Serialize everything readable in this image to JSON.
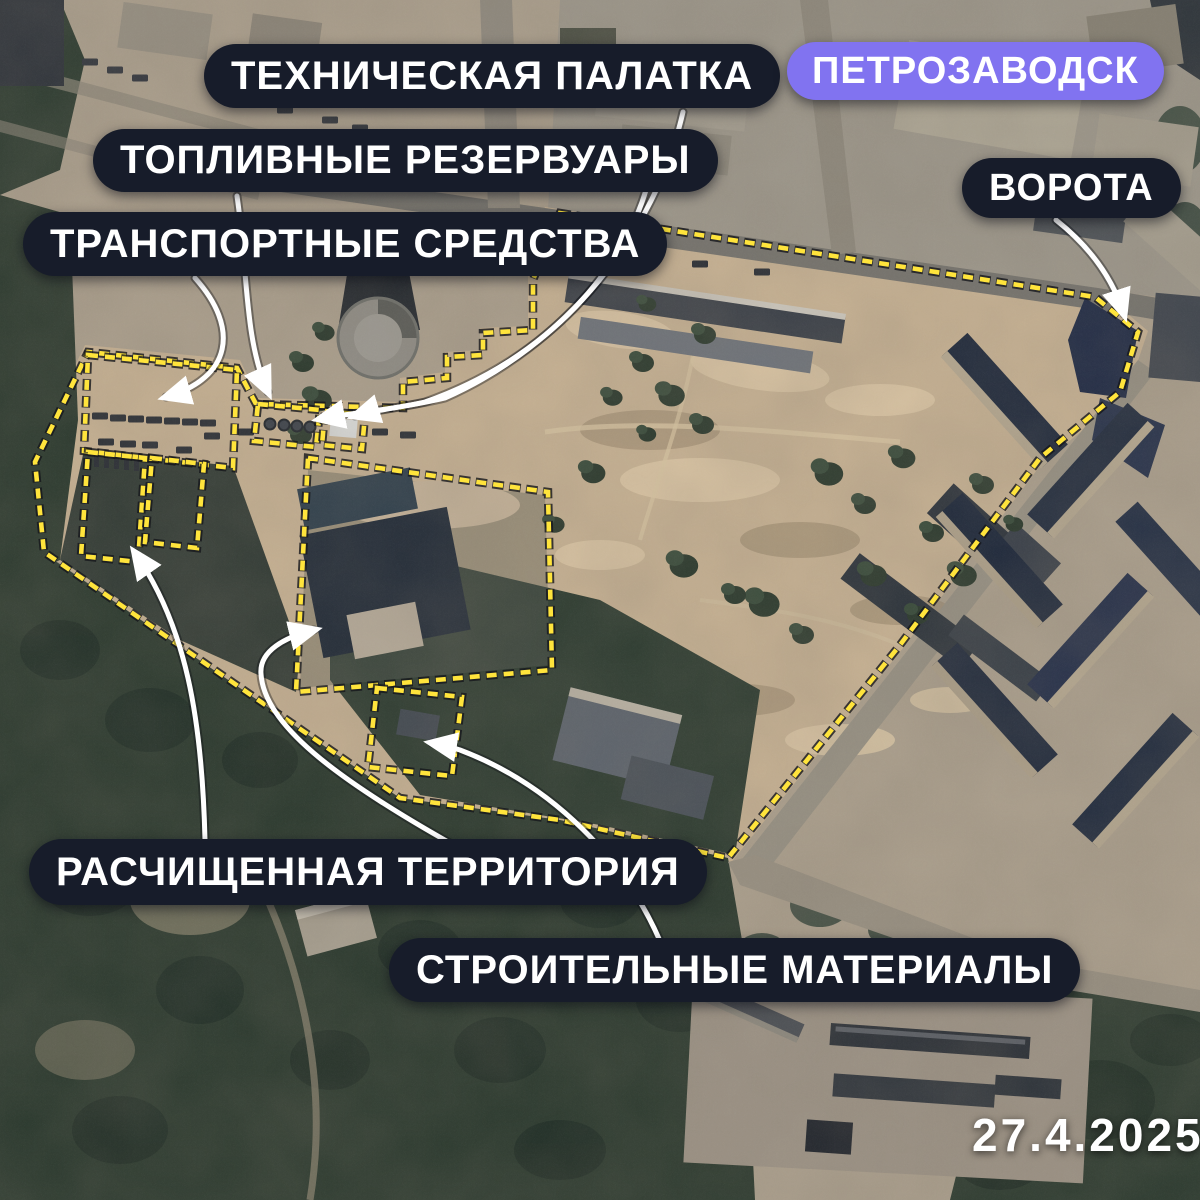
{
  "city_badge": "ПЕТРОЗАВОДСК",
  "annotations": {
    "technical_tent": "ТЕХНИЧЕСКАЯ ПАЛАТКА",
    "fuel_reservoirs": "ТОПЛИВНЫЕ РЕЗЕРВУАРЫ",
    "vehicles": "ТРАНСПОРТНЫЕ СРЕДСТВА",
    "gate": "ВОРОТА",
    "cleared_territory": "РАСЧИЩЕННАЯ ТЕРРИТОРИЯ",
    "construction_materials": "СТРОИТЕЛЬНЫЕ МАТЕРИАЛЫ"
  },
  "date_label": "27.4.2025",
  "colors": {
    "label_bg": "#171c2a",
    "label_text": "#ffffff",
    "city_badge_bg": "#8173f0",
    "outline_yellow": "#ffe43c",
    "arrow_white": "#ffffff"
  }
}
